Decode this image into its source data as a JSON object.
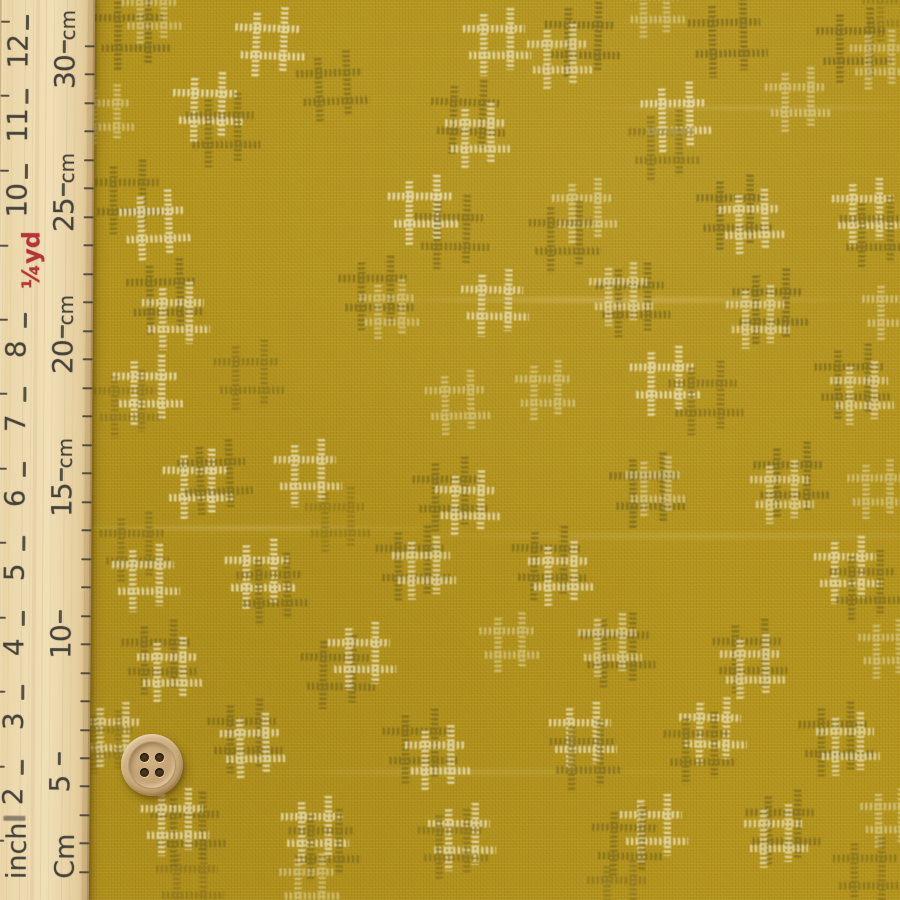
{
  "colors": {
    "fabric_base": "#b4941c",
    "motif_white": "#eadfb4",
    "motif_dark": "#7e6b1e",
    "ruler_wood": "#e9d6a9",
    "ruler_ink": "#44423a",
    "ruler_red": "#b23538",
    "button_wood": "#c8a87a",
    "button_hole": "#3a2a18"
  },
  "ruler": {
    "bottom_labels": {
      "inch": "inch",
      "cm": "Cm"
    },
    "quarter_yard": {
      "label": "¼yd",
      "y": 246
    },
    "inch_marks": [
      {
        "label": "12",
        "y": 22
      },
      {
        "label": "11",
        "y": 96
      },
      {
        "label": "10",
        "y": 171
      },
      {
        "label": "8",
        "y": 320
      },
      {
        "label": "7",
        "y": 394
      },
      {
        "label": "6",
        "y": 469
      },
      {
        "label": "5",
        "y": 543
      },
      {
        "label": "4",
        "y": 618
      },
      {
        "label": "3",
        "y": 692
      },
      {
        "label": "2",
        "y": 767
      }
    ],
    "cm_marks": [
      {
        "label": "30",
        "unit": "cm",
        "y": 46
      },
      {
        "label": "25",
        "unit": "cm",
        "y": 189
      },
      {
        "label": "20",
        "unit": "cm",
        "y": 331
      },
      {
        "label": "15",
        "unit": "cm",
        "y": 474
      },
      {
        "label": "10",
        "unit": "",
        "y": 616
      },
      {
        "label": "5",
        "unit": "",
        "y": 758
      }
    ],
    "inch_edge_tick_ys": [
      841,
      767,
      692,
      618,
      543,
      469,
      394,
      320,
      246,
      171,
      96,
      22
    ],
    "cm_edge_tick_ys": [
      872,
      843,
      815,
      786,
      758,
      730,
      701,
      673,
      644,
      616,
      587,
      559,
      530,
      502,
      473,
      445,
      416,
      388,
      359,
      331,
      302,
      274,
      245,
      217,
      188,
      160,
      131,
      103,
      74,
      46
    ]
  },
  "button": {
    "cx": 152,
    "cy": 765,
    "outer_r": 31,
    "hole_r": 4.5,
    "hole_offset": 7.5
  },
  "fabric": {
    "motif_colors": {
      "w": "#eadfb4",
      "d": "#7e6b1e"
    },
    "motifs": [
      [
        655,
        8,
        "w",
        54,
        0.5,
        0
      ],
      [
        892,
        12,
        "d",
        54,
        0.45,
        0
      ],
      [
        133,
        33,
        "d",
        70,
        0.8,
        0
      ],
      [
        152,
        14,
        "w",
        55,
        0.5,
        0
      ],
      [
        270,
        42,
        "w",
        64,
        0.88,
        2
      ],
      [
        333,
        87,
        "d",
        66,
        0.7,
        -2
      ],
      [
        497,
        42,
        "w",
        62,
        0.82,
        0
      ],
      [
        583,
        40,
        "d",
        70,
        0.8,
        1
      ],
      [
        560,
        57,
        "w",
        60,
        0.75,
        0
      ],
      [
        728,
        38,
        "d",
        72,
        0.78,
        -1
      ],
      [
        855,
        46,
        "d",
        70,
        0.8,
        0
      ],
      [
        880,
        60,
        "w",
        55,
        0.5,
        0
      ],
      [
        105,
        115,
        "w",
        56,
        0.5,
        0
      ],
      [
        208,
        107,
        "w",
        64,
        0.88,
        1
      ],
      [
        223,
        130,
        "d",
        68,
        0.7,
        0
      ],
      [
        468,
        117,
        "d",
        68,
        0.75,
        2
      ],
      [
        478,
        136,
        "w",
        60,
        0.8,
        0
      ],
      [
        676,
        117,
        "w",
        64,
        0.88,
        -1
      ],
      [
        665,
        146,
        "d",
        66,
        0.6,
        0
      ],
      [
        798,
        100,
        "w",
        60,
        0.55,
        0
      ],
      [
        128,
        197,
        "d",
        68,
        0.75,
        0
      ],
      [
        155,
        225,
        "w",
        64,
        0.85,
        -2
      ],
      [
        423,
        210,
        "w",
        64,
        0.88,
        0
      ],
      [
        452,
        232,
        "d",
        68,
        0.7,
        1
      ],
      [
        585,
        211,
        "w",
        60,
        0.6,
        0
      ],
      [
        565,
        237,
        "d",
        66,
        0.7,
        0
      ],
      [
        735,
        213,
        "d",
        70,
        0.8,
        0
      ],
      [
        752,
        222,
        "w",
        60,
        0.8,
        -1
      ],
      [
        866,
        212,
        "w",
        62,
        0.8,
        0
      ],
      [
        876,
        233,
        "d",
        66,
        0.7,
        0
      ],
      [
        165,
        297,
        "d",
        70,
        0.8,
        -1
      ],
      [
        176,
        316,
        "w",
        62,
        0.8,
        0
      ],
      [
        376,
        293,
        "d",
        68,
        0.75,
        0
      ],
      [
        390,
        310,
        "w",
        56,
        0.5,
        0
      ],
      [
        495,
        303,
        "w",
        62,
        0.8,
        1
      ],
      [
        633,
        300,
        "d",
        68,
        0.75,
        0
      ],
      [
        621,
        294,
        "w",
        58,
        0.7,
        0
      ],
      [
        771,
        307,
        "d",
        70,
        0.8,
        0
      ],
      [
        758,
        317,
        "w",
        58,
        0.7,
        0
      ],
      [
        893,
        311,
        "w",
        56,
        0.55,
        0
      ],
      [
        148,
        390,
        "w",
        64,
        0.85,
        0
      ],
      [
        128,
        404,
        "d",
        62,
        0.5,
        0
      ],
      [
        250,
        376,
        "d",
        66,
        0.55,
        0
      ],
      [
        458,
        403,
        "w",
        60,
        0.5,
        -1
      ],
      [
        546,
        391,
        "w",
        56,
        0.5,
        0
      ],
      [
        665,
        381,
        "w",
        64,
        0.85,
        0
      ],
      [
        706,
        398,
        "d",
        68,
        0.65,
        0
      ],
      [
        853,
        382,
        "d",
        70,
        0.75,
        0
      ],
      [
        862,
        393,
        "w",
        58,
        0.7,
        0
      ],
      [
        198,
        484,
        "w",
        64,
        0.85,
        0
      ],
      [
        215,
        477,
        "d",
        68,
        0.75,
        -2
      ],
      [
        308,
        473,
        "w",
        62,
        0.8,
        0
      ],
      [
        338,
        520,
        "d",
        60,
        0.45,
        0
      ],
      [
        450,
        494,
        "d",
        68,
        0.75,
        0
      ],
      [
        468,
        503,
        "w",
        60,
        0.8,
        1
      ],
      [
        648,
        491,
        "d",
        70,
        0.8,
        0
      ],
      [
        656,
        487,
        "w",
        56,
        0.55,
        0
      ],
      [
        792,
        480,
        "d",
        70,
        0.8,
        0
      ],
      [
        782,
        492,
        "w",
        58,
        0.7,
        0
      ],
      [
        878,
        490,
        "w",
        56,
        0.5,
        0
      ],
      [
        135,
        547,
        "d",
        64,
        0.6,
        0
      ],
      [
        146,
        578,
        "w",
        62,
        0.8,
        0
      ],
      [
        260,
        574,
        "w",
        64,
        0.85,
        0
      ],
      [
        273,
        589,
        "d",
        66,
        0.7,
        -1
      ],
      [
        413,
        563,
        "d",
        68,
        0.75,
        0
      ],
      [
        424,
        568,
        "w",
        58,
        0.75,
        0
      ],
      [
        549,
        563,
        "d",
        68,
        0.75,
        1
      ],
      [
        561,
        574,
        "w",
        60,
        0.8,
        0
      ],
      [
        848,
        570,
        "w",
        62,
        0.8,
        0
      ],
      [
        866,
        586,
        "d",
        66,
        0.7,
        0
      ],
      [
        159,
        657,
        "d",
        68,
        0.75,
        0
      ],
      [
        170,
        670,
        "w",
        60,
        0.8,
        0
      ],
      [
        338,
        672,
        "d",
        68,
        0.75,
        1
      ],
      [
        362,
        656,
        "w",
        62,
        0.8,
        0
      ],
      [
        510,
        643,
        "w",
        56,
        0.5,
        0
      ],
      [
        618,
        650,
        "d",
        68,
        0.75,
        0
      ],
      [
        610,
        645,
        "w",
        58,
        0.65,
        0
      ],
      [
        750,
        656,
        "d",
        68,
        0.75,
        0
      ],
      [
        753,
        667,
        "w",
        60,
        0.75,
        0
      ],
      [
        888,
        649,
        "w",
        54,
        0.5,
        0
      ],
      [
        113,
        735,
        "w",
        60,
        0.75,
        0
      ],
      [
        106,
        742,
        "d",
        58,
        0.5,
        0
      ],
      [
        245,
        736,
        "d",
        68,
        0.75,
        0
      ],
      [
        253,
        746,
        "w",
        60,
        0.8,
        -1
      ],
      [
        420,
        746,
        "d",
        68,
        0.75,
        0
      ],
      [
        438,
        758,
        "w",
        60,
        0.8,
        0
      ],
      [
        583,
        736,
        "w",
        62,
        0.8,
        0
      ],
      [
        586,
        756,
        "d",
        66,
        0.7,
        0
      ],
      [
        713,
        731,
        "w",
        62,
        0.8,
        1
      ],
      [
        700,
        748,
        "d",
        66,
        0.7,
        0
      ],
      [
        836,
        739,
        "d",
        68,
        0.75,
        0
      ],
      [
        848,
        744,
        "w",
        58,
        0.75,
        0
      ],
      [
        188,
        829,
        "d",
        68,
        0.75,
        0
      ],
      [
        175,
        822,
        "w",
        62,
        0.8,
        0
      ],
      [
        315,
        830,
        "w",
        62,
        0.8,
        0
      ],
      [
        325,
        845,
        "d",
        66,
        0.7,
        0
      ],
      [
        462,
        837,
        "w",
        62,
        0.8,
        0
      ],
      [
        453,
        844,
        "d",
        64,
        0.6,
        0
      ],
      [
        654,
        828,
        "w",
        62,
        0.8,
        0
      ],
      [
        628,
        842,
        "d",
        66,
        0.7,
        1
      ],
      [
        783,
        827,
        "d",
        68,
        0.75,
        0
      ],
      [
        776,
        836,
        "w",
        58,
        0.75,
        0
      ],
      [
        890,
        818,
        "w",
        54,
        0.55,
        0
      ],
      [
        190,
        882,
        "d",
        62,
        0.5,
        0
      ],
      [
        310,
        884,
        "w",
        56,
        0.5,
        0
      ],
      [
        620,
        893,
        "d",
        60,
        0.5,
        0
      ],
      [
        868,
        872,
        "d",
        64,
        0.6,
        0
      ]
    ]
  }
}
